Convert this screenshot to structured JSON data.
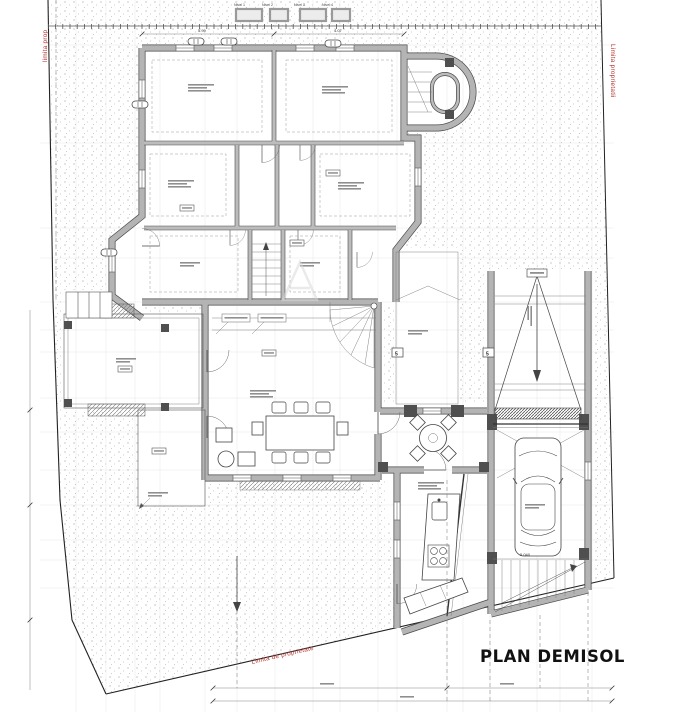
{
  "title": "PLAN DEMISOL",
  "boundary": {
    "left": "limita prop",
    "right": "Limita proprietatii",
    "bottom": "Limita de proprietate"
  },
  "levels": {
    "items": [
      "Nivel 1",
      "Nivel 2",
      "Nivel 3",
      "Nivel 4"
    ]
  },
  "markers": {
    "window_left": "5",
    "window_right": "5"
  },
  "dims": {
    "room_a": "5.99",
    "room_b": "4.07",
    "garage_bay": "5.040"
  },
  "colors": {
    "boundary_red": "#b5342e",
    "wall_gray": "#b4b4b4",
    "wall_edge": "#4a4a4a",
    "line": "#666666",
    "title": "#111111"
  }
}
